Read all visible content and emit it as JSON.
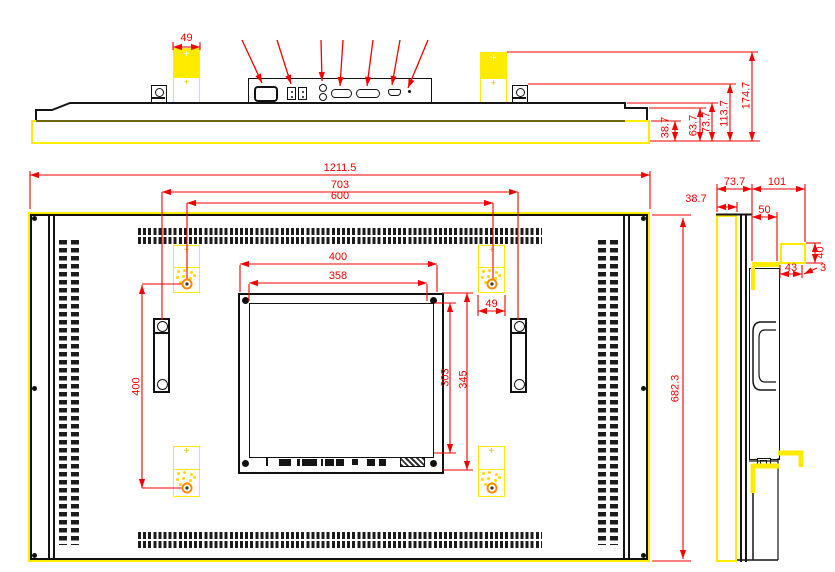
{
  "dimensions": {
    "top_view": {
      "bracket_width": "49",
      "depth_to_bezel": "38.7",
      "depth_to_step": "63.7",
      "depth_to_top_surface": "73.7",
      "depth_to_handle_bracket": "113.7",
      "depth_to_mount_bracket": "174.7"
    },
    "rear_view": {
      "overall_width": "1211.5",
      "handle_hole_span": "703",
      "mount_hole_span_h": "600",
      "mount_hole_span_v": "400",
      "mount_bracket_width": "49",
      "panel_width": "400",
      "screen_width": "358",
      "screen_height": "303",
      "panel_height": "345",
      "overall_height": "682.3"
    },
    "side_view": {
      "bezel_depth": "38.7",
      "front_section_depth": "73.7",
      "total_depth": "101",
      "body_depth": "50",
      "hook_width": "43",
      "hook_height": "40",
      "hook_lip": "3"
    }
  },
  "colors": {
    "dimension_lines": "#f40000",
    "highlight": "#ffeb00",
    "drawing_lines": "#151515",
    "mount_hole_accent": "#ff8c00",
    "background": "#ffffff"
  }
}
